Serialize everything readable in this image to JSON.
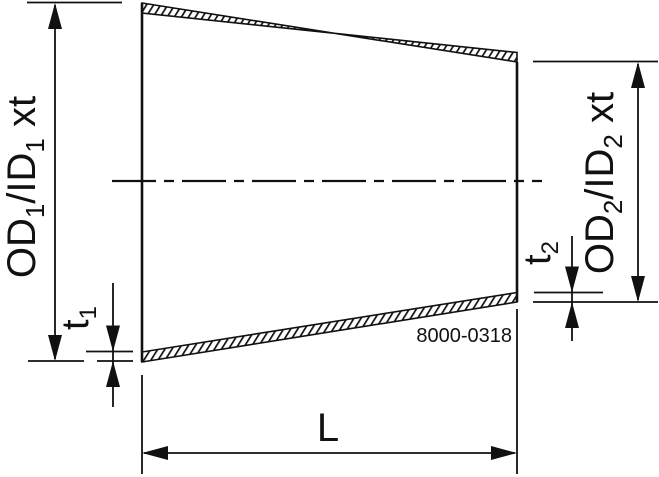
{
  "drawing": {
    "part_number": "8000-0318",
    "dim_od1": {
      "pre": "OD",
      "sub1": "1",
      "mid": "/ID",
      "sub2": "1",
      "post": " xt"
    },
    "dim_od2": {
      "pre": "OD",
      "sub1": "2",
      "mid": "/ID",
      "sub2": "2",
      "post": " xt"
    },
    "dim_t1": {
      "pre": "t",
      "sub": "1"
    },
    "dim_t2": {
      "pre": "t",
      "sub": "2"
    },
    "dim_length": "L",
    "colors": {
      "line": "#111111",
      "background": "#ffffff"
    }
  }
}
